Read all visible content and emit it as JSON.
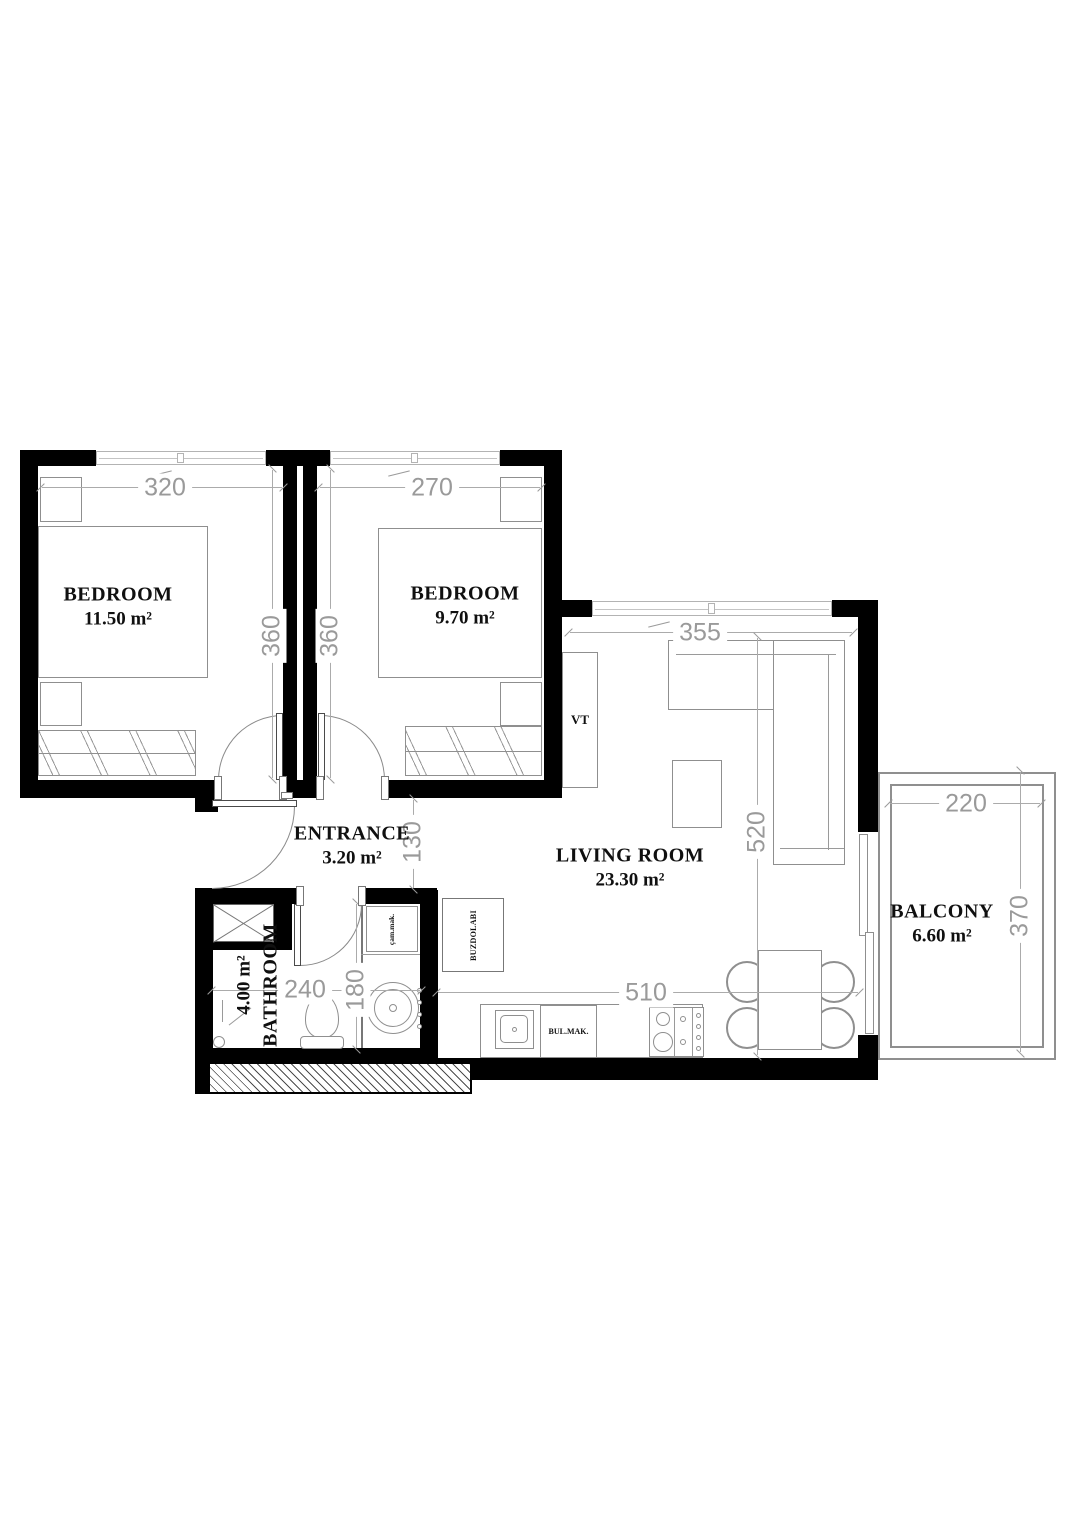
{
  "plan": {
    "rooms": {
      "bedroom1": {
        "name": "BEDROOM",
        "area": "11.50 m²"
      },
      "bedroom2": {
        "name": "BEDROOM",
        "area": "9.70 m²"
      },
      "living": {
        "name": "LIVING ROOM",
        "area": "23.30 m²"
      },
      "entrance": {
        "name": "ENTRANCE",
        "area": "3.20 m²"
      },
      "bathroom": {
        "name": "BATHROOM",
        "area": "4.00 m²"
      },
      "balcony": {
        "name": "BALCONY",
        "area": "6.60 m²"
      }
    },
    "dimensions": {
      "bedroom1_width": "320",
      "bedroom2_width": "270",
      "bedroom1_depth": "360",
      "bedroom2_depth": "360",
      "living_width": "355",
      "living_depth": "520",
      "hall_width": "130",
      "bathroom_width": "240",
      "bathroom_depth": "180",
      "kitchen_run": "510",
      "balcony_width": "220",
      "balcony_depth": "370"
    },
    "labels": {
      "tv": "VT",
      "dishwasher": "BUL.MAK.",
      "fridge": "BUZDOLABI",
      "washing_machine": "çam.mak."
    },
    "colors": {
      "wall": "#000000",
      "furniture_line": "#8f8f8f",
      "dim_text": "#9a9a9a",
      "label_text": "#101010"
    }
  }
}
